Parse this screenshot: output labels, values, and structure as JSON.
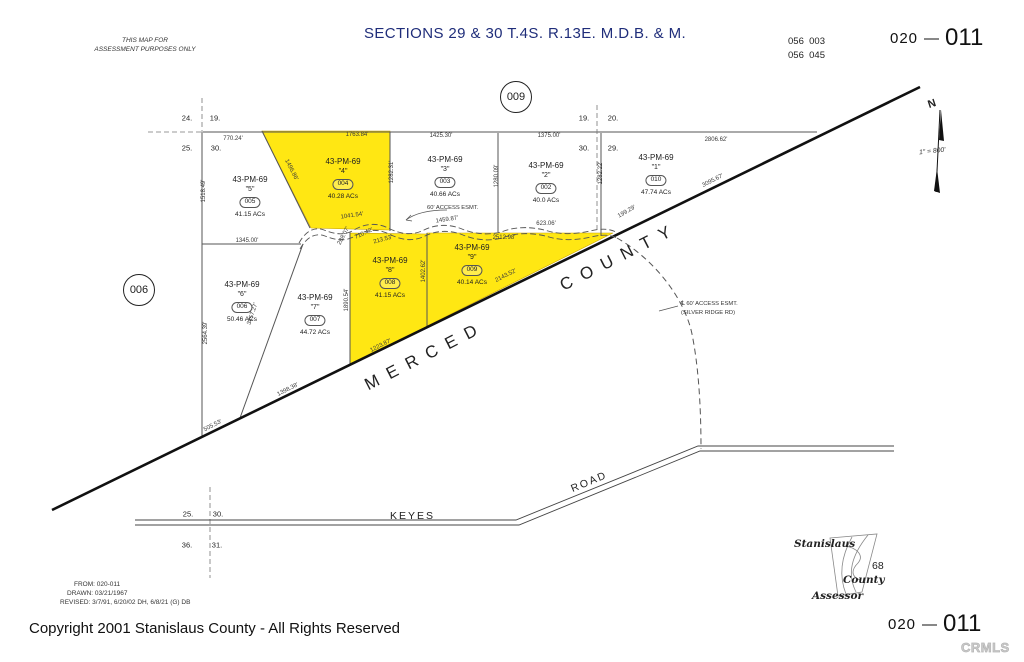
{
  "header": {
    "disclaimer_line1": "THIS MAP FOR",
    "disclaimer_line2": "ASSESSMENT PURPOSES ONLY",
    "title": "SECTIONS 29 & 30 T.4S. R.13E. M.D.B. & M.",
    "ref_code_line1": "056  003",
    "ref_code_line2": "056  045",
    "sheet_prefix": "020",
    "sheet_dash": "—",
    "sheet_suffix": "011"
  },
  "map": {
    "county_line_label": "MERCED  COUNTY",
    "keyes_label": "KEYES",
    "road_label": "ROAD",
    "access_esmt_label": "60' ACCESS ESMT.",
    "silver_ridge_line1": "℄ 60' ACCESS ESMT.",
    "silver_ridge_line2": "(SILVER RIDGE RD)",
    "north_label": "N",
    "scale_label": "1\" = 800'",
    "highlight_color": "#ffe713",
    "circles": [
      {
        "label": "009",
        "x": 516,
        "y": 97
      },
      {
        "label": "006",
        "x": 139,
        "y": 290
      }
    ],
    "parcels": [
      {
        "map_ref": "43-PM-69",
        "name": "\"5\"",
        "number": "005",
        "acreage": "41.15 ACs",
        "x": 250,
        "y": 175
      },
      {
        "map_ref": "43-PM-69",
        "name": "\"4\"",
        "number": "004",
        "acreage": "40.28 ACs",
        "x": 343,
        "y": 157
      },
      {
        "map_ref": "43-PM-69",
        "name": "\"3\"",
        "number": "003",
        "acreage": "40.66 ACs",
        "x": 445,
        "y": 155
      },
      {
        "map_ref": "43-PM-69",
        "name": "\"2\"",
        "number": "002",
        "acreage": "40.0 ACs",
        "x": 546,
        "y": 161
      },
      {
        "map_ref": "43-PM-69",
        "name": "\"1\"",
        "number": "010",
        "acreage": "47.74 ACs",
        "x": 656,
        "y": 153
      },
      {
        "map_ref": "43-PM-69",
        "name": "\"6\"",
        "number": "006",
        "acreage": "50.46 ACs",
        "x": 242,
        "y": 280
      },
      {
        "map_ref": "43-PM-69",
        "name": "\"7\"",
        "number": "007",
        "acreage": "44.72 ACs",
        "x": 315,
        "y": 293
      },
      {
        "map_ref": "43-PM-69",
        "name": "\"8\"",
        "number": "008",
        "acreage": "41.15 ACs",
        "x": 390,
        "y": 256
      },
      {
        "map_ref": "43-PM-69",
        "name": "\"9\"",
        "number": "009",
        "acreage": "40.14 ACs",
        "x": 472,
        "y": 243
      }
    ],
    "section_corners": [
      {
        "t": "24.",
        "x": 187,
        "y": 118
      },
      {
        "t": "19.",
        "x": 215,
        "y": 118
      },
      {
        "t": "25.",
        "x": 187,
        "y": 148
      },
      {
        "t": "30.",
        "x": 216,
        "y": 148
      },
      {
        "t": "19.",
        "x": 584,
        "y": 118
      },
      {
        "t": "20.",
        "x": 613,
        "y": 118
      },
      {
        "t": "30.",
        "x": 584,
        "y": 148
      },
      {
        "t": "29.",
        "x": 613,
        "y": 148
      },
      {
        "t": "25.",
        "x": 188,
        "y": 514
      },
      {
        "t": "30.",
        "x": 218,
        "y": 514
      },
      {
        "t": "36.",
        "x": 187,
        "y": 545
      },
      {
        "t": "31.",
        "x": 217,
        "y": 545
      }
    ],
    "dimensions": [
      {
        "t": "770.24'",
        "x": 233,
        "y": 139,
        "r": 0
      },
      {
        "t": "1763.84'",
        "x": 357,
        "y": 135,
        "r": 0
      },
      {
        "t": "1425.30'",
        "x": 441,
        "y": 136,
        "r": 0
      },
      {
        "t": "1375.00'",
        "x": 549,
        "y": 136,
        "r": 0
      },
      {
        "t": "2806.62'",
        "x": 716,
        "y": 140,
        "r": 0
      },
      {
        "t": "1518.49'",
        "x": 204,
        "y": 191,
        "r": -90
      },
      {
        "t": "1496.86'",
        "x": 291,
        "y": 170,
        "r": 63
      },
      {
        "t": "1282.31'",
        "x": 392,
        "y": 172,
        "r": -90
      },
      {
        "t": "1280.09'",
        "x": 497,
        "y": 176,
        "r": -90
      },
      {
        "t": "1282.22'",
        "x": 601,
        "y": 173,
        "r": -90
      },
      {
        "t": "1345.00'",
        "x": 247,
        "y": 241,
        "r": 0
      },
      {
        "t": "288.07'",
        "x": 344,
        "y": 236,
        "r": -62
      },
      {
        "t": "710.42'",
        "x": 364,
        "y": 234,
        "r": -25
      },
      {
        "t": "1041.54'",
        "x": 352,
        "y": 216,
        "r": -8
      },
      {
        "t": "213.53'",
        "x": 383,
        "y": 240,
        "r": -15
      },
      {
        "t": "1459.87'",
        "x": 447,
        "y": 220,
        "r": -8
      },
      {
        "t": "2512.98'",
        "x": 504,
        "y": 238,
        "r": 0
      },
      {
        "t": "623.06'",
        "x": 546,
        "y": 224,
        "r": 0
      },
      {
        "t": "199.29'",
        "x": 627,
        "y": 212,
        "r": -30
      },
      {
        "t": "2564.39'",
        "x": 206,
        "y": 333,
        "r": -90
      },
      {
        "t": "3457.27'",
        "x": 253,
        "y": 314,
        "r": -72
      },
      {
        "t": "1890.54'",
        "x": 347,
        "y": 300,
        "r": -90
      },
      {
        "t": "1402.62'",
        "x": 424,
        "y": 271,
        "r": -90
      },
      {
        "t": "1223.87'",
        "x": 381,
        "y": 346,
        "r": -27
      },
      {
        "t": "2143.52'",
        "x": 506,
        "y": 276,
        "r": -27
      },
      {
        "t": "3095.67'",
        "x": 713,
        "y": 181,
        "r": -27
      },
      {
        "t": "505.53'",
        "x": 213,
        "y": 426,
        "r": -27
      },
      {
        "t": "1398.38'",
        "x": 288,
        "y": 390,
        "r": -27
      }
    ]
  },
  "footer": {
    "from": "FROM: 020-011",
    "drawn": "DRAWN: 03/21/1967",
    "revised": "REVISED: 3/7/91, 6/20/02 DH, 6/8/21 (G) DB",
    "copyright": "Copyright 2001 Stanislaus County - All Rights Reserved",
    "assessor_line1": "Stanislaus",
    "assessor_line2": "County",
    "assessor_line3": "Assessor",
    "assessor_number": "68",
    "sheet_prefix": "020",
    "sheet_dash": "—",
    "sheet_suffix": "011",
    "watermark": "CRMLS"
  }
}
